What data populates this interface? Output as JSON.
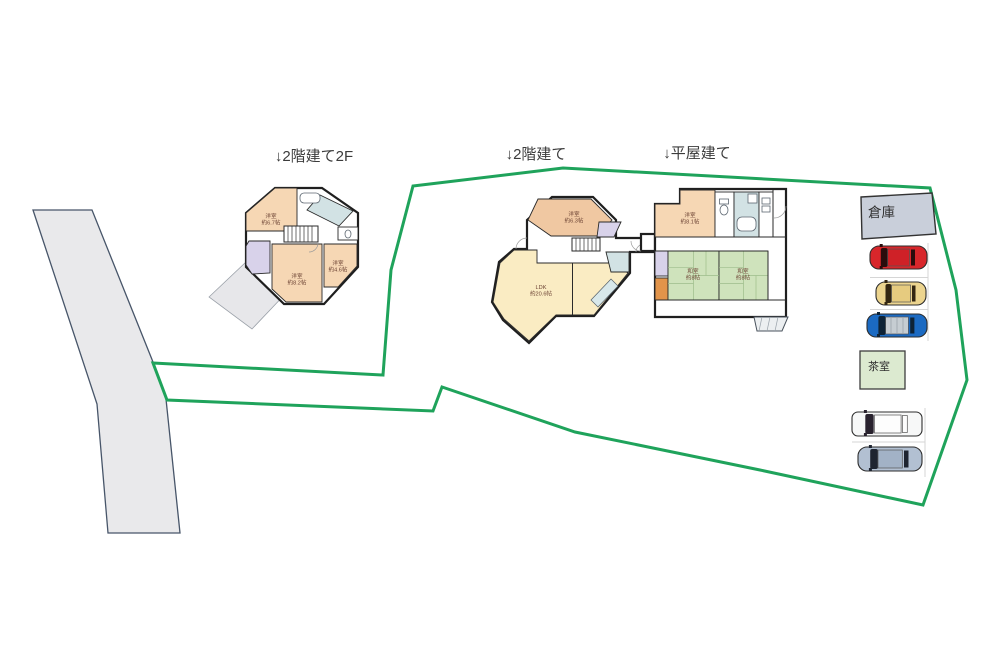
{
  "annotations": {
    "b1_title": "↓2階建て2F",
    "b2_title": "↓2階建て",
    "b3_title": "↓平屋建て"
  },
  "rooms": {
    "b1_youshitsu67": {
      "name": "洋室",
      "size": "約6.7帖"
    },
    "b1_youshitsu82": {
      "name": "洋室",
      "size": "約8.2帖"
    },
    "b1_youshitsu46": {
      "name": "洋室",
      "size": "約4.6帖"
    },
    "b2_youshitsu63": {
      "name": "洋室",
      "size": "約6.3帖"
    },
    "b2_ldk": {
      "name": "LDK",
      "size": "約20.6帖"
    },
    "b3_youshitsu81": {
      "name": "洋室",
      "size": "約8.1帖"
    },
    "b3_washitsu_left": {
      "name": "和室",
      "size": "約8帖"
    },
    "b3_washitsu_right": {
      "name": "和室",
      "size": "約8帖"
    }
  },
  "structures": {
    "warehouse_label": "倉庫",
    "tearoom_label": "茶室"
  },
  "colors": {
    "boundary": "#1fa35b",
    "road_fill": "#e9e9eb",
    "road_stroke": "#475569",
    "room_peach": "#f6d7b4",
    "room_peach_dark": "#f0c8a2",
    "room_yellow": "#faecc3",
    "room_tatami": "#cfe3bc",
    "room_blue": "#d2e2e4",
    "room_purple": "#d8d2ea",
    "room_orange": "#e2944a",
    "porch_gray": "#e7e7ea",
    "warehouse_fill": "#c9cfda",
    "tearoom_fill": "#dcead0",
    "step_fill": "#eceff1"
  },
  "cars": [
    {
      "name": "red-car",
      "body": "#d8262b",
      "cabin": "#2a0c0c",
      "roof": "#cf2127"
    },
    {
      "name": "yellow-car",
      "body": "#ecd48e",
      "cabin": "#332611",
      "roof": "#e6cb7f"
    },
    {
      "name": "blue-car",
      "body": "#1b6ac2",
      "cabin": "#0e2336",
      "roof": "#c6cdd2"
    },
    {
      "name": "white-van",
      "body": "#f7f8f8",
      "cabin": "#29222e",
      "roof": "#fdfdfd"
    },
    {
      "name": "gray-car",
      "body": "#b2c0d2",
      "cabin": "#1e2430",
      "roof": "#a2b2c6"
    }
  ]
}
